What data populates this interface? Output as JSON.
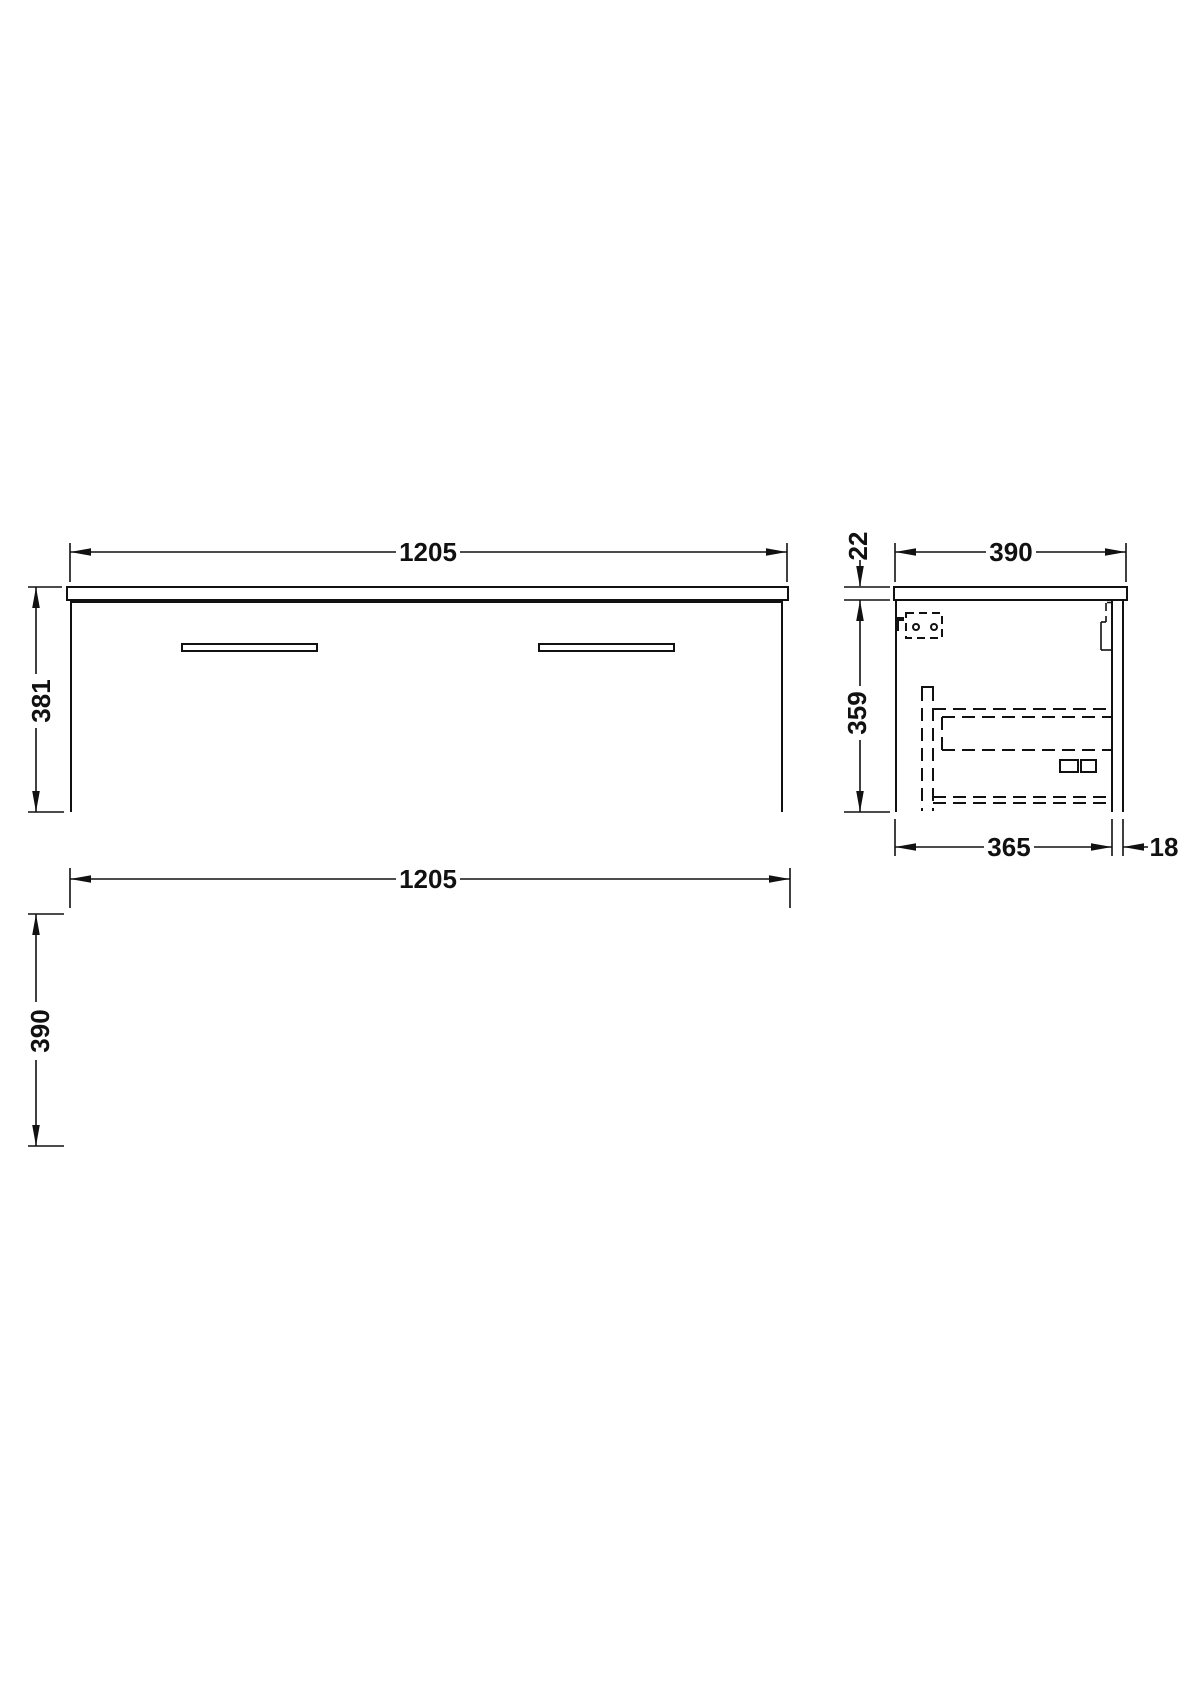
{
  "drawing": {
    "line_color": "#111111",
    "background": "#ffffff",
    "front": {
      "width_label": "1205",
      "height_label": "381"
    },
    "side": {
      "depth_label": "390",
      "worktop_thickness_label": "22",
      "carcass_height_label": "359",
      "carcass_depth_label": "365",
      "back_panel_label": "18"
    },
    "plan": {
      "width_label": "1205",
      "depth_label": "390"
    }
  }
}
